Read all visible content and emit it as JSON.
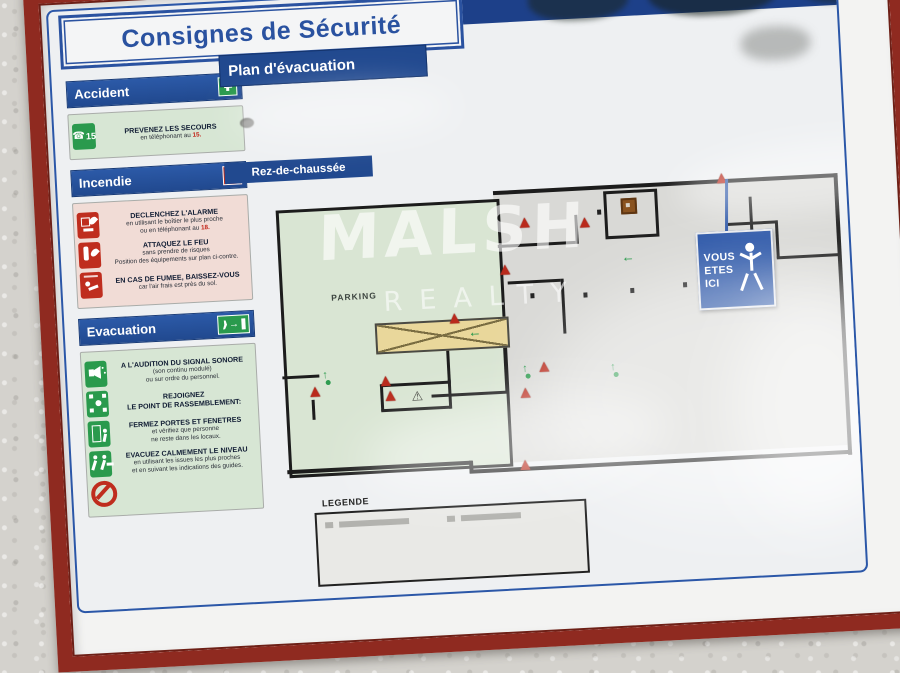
{
  "poster": {
    "title": "Consignes de Sécurité"
  },
  "accident": {
    "header": "Accident",
    "item": {
      "title": "PREVENEZ LES SECOURS",
      "line_prefix": "en téléphonant au ",
      "number": "15.",
      "badge_number": "15"
    }
  },
  "incendie": {
    "header": "Incendie",
    "alarm": {
      "title": "DECLENCHEZ L'ALARME",
      "line1": "en utilisant le boîtier le plus proche",
      "line_prefix": "ou en téléphonant au ",
      "number": "18."
    },
    "feu": {
      "title": "ATTAQUEZ LE FEU",
      "line1": "sans prendre de risques",
      "line2": "Position des équipements sur plan ci-contre."
    },
    "fumee": {
      "title": "EN CAS DE FUMEE, BAISSEZ-VOUS",
      "line1": "car l'air frais est près du sol."
    }
  },
  "evacuation": {
    "header": "Evacuation",
    "signal": {
      "title": "A L'AUDITION DU SIGNAL SONORE",
      "line1": "(son continu modulé)",
      "line2": "ou sur ordre du personnel."
    },
    "rassemblement": {
      "title": "REJOIGNEZ",
      "title2": "LE POINT DE RASSEMBLEMENT:"
    },
    "fermez": {
      "title": "FERMEZ PORTES ET FENETRES",
      "line1": "et vérifiez que personne",
      "line2": "ne reste dans les locaux."
    },
    "evacuez": {
      "title": "EVACUEZ CALMEMENT LE NIVEAU",
      "line1": "en utilisant les issues les plus proches",
      "line2": "et en suivant les indications des guides."
    }
  },
  "plan": {
    "header": "Plan d'évacuation",
    "floor_label": "Rez-de-chaussée",
    "parking_label": "PARKING",
    "legend_label": "LEGENDE",
    "you_are_here": {
      "line1": "VOUS",
      "line2": "ETES",
      "line3": "ICI"
    }
  },
  "watermark": {
    "brand": "MALSH",
    "sub": "REALTY"
  },
  "colors": {
    "frame_red": "#8f2a20",
    "panel_blue": "#21498f",
    "band_blue": "#1d4089",
    "green": "#2a9a4d",
    "panel_green_bg": "#d7e6d4",
    "panel_pink_bg": "#f1dcd6",
    "alert_red": "#bf2d1e",
    "parking_green": "#d9e5d3",
    "plan_gray": "#d9d9d6",
    "ramp_yellow": "#e9d79b",
    "badge_blue": "#2a55a7"
  }
}
